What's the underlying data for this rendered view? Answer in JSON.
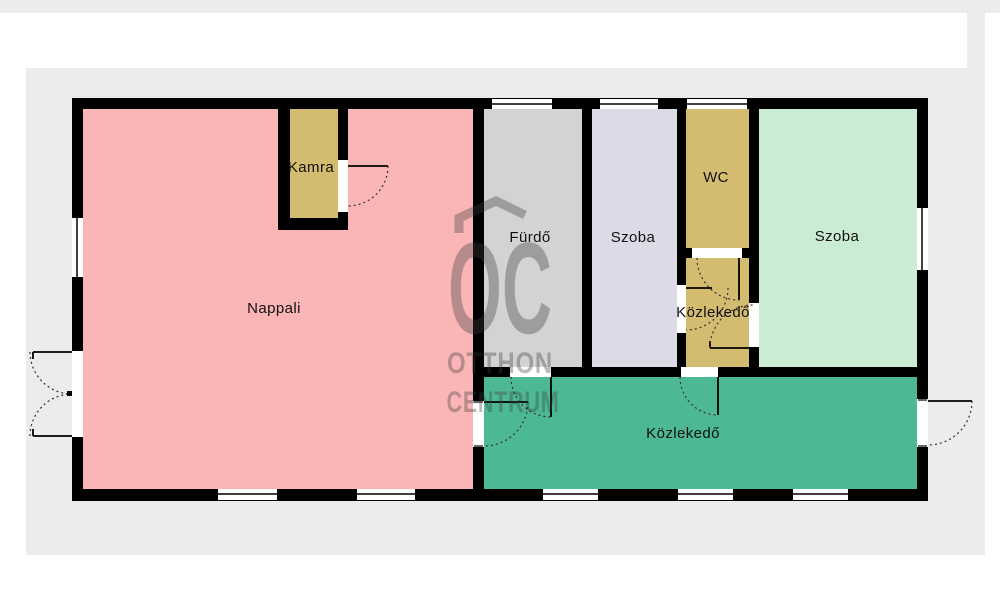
{
  "watermark": {
    "logo": "OC",
    "line1": "OTTHON",
    "line2": "CENTRUM",
    "color": "#3c3c3c"
  },
  "rooms": [
    {
      "id": "nappali",
      "label": "Nappali",
      "color": "#fab6b6"
    },
    {
      "id": "kamra",
      "label": "Kamra",
      "color": "#d3bc70"
    },
    {
      "id": "furdo",
      "label": "Fürdő",
      "color": "#d3d3d3"
    },
    {
      "id": "szoba-1",
      "label": "Szoba",
      "color": "#dbdbe7"
    },
    {
      "id": "wc",
      "label": "WC",
      "color": "#d3bc70"
    },
    {
      "id": "kozlekedo-1",
      "label": "Közlekedő",
      "color": "#d3bc70"
    },
    {
      "id": "szoba-2",
      "label": "Szoba",
      "color": "#c9ecd2"
    },
    {
      "id": "kozlekedo-2",
      "label": "Közlekedő",
      "color": "#4db894"
    }
  ],
  "canvas": {
    "page_background": "#ffffff",
    "panel_background": "#edecea",
    "wall_color": "#000000",
    "opening_color": "#ffffff"
  }
}
